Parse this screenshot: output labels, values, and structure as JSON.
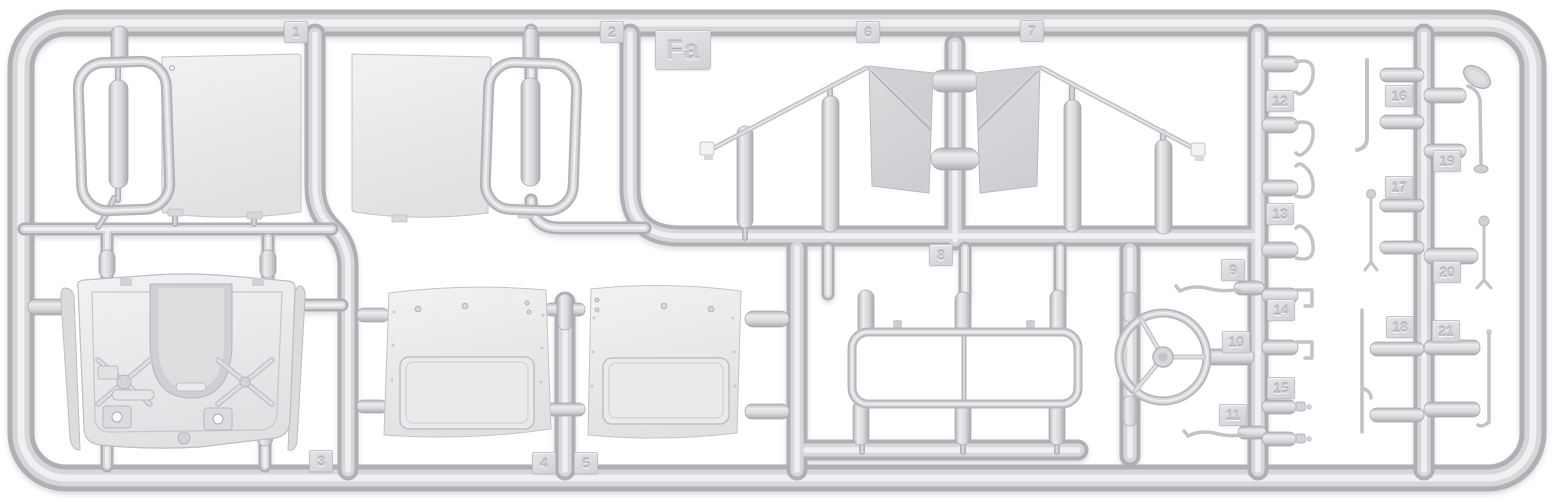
{
  "scene": {
    "subject": "injection-molded model kit sprue with numbered part tags",
    "colors": {
      "background": "#ffffff",
      "plastic_base": "#d7d7da",
      "plastic_highlight": "#f0f0f2",
      "plastic_shadow": "#afafb6",
      "panel_face": "#ededef",
      "glass_pane": "#d8d8db",
      "tag_plate": "#e6e6e9",
      "tag_text": "#c4c4ca"
    }
  },
  "sprue": {
    "frame_label": "Fa",
    "part_tags": [
      "1",
      "2",
      "3",
      "4",
      "5",
      "6",
      "7",
      "8",
      "9",
      "10",
      "11",
      "12",
      "13",
      "14",
      "15",
      "16",
      "17",
      "18",
      "19",
      "20",
      "21"
    ]
  }
}
